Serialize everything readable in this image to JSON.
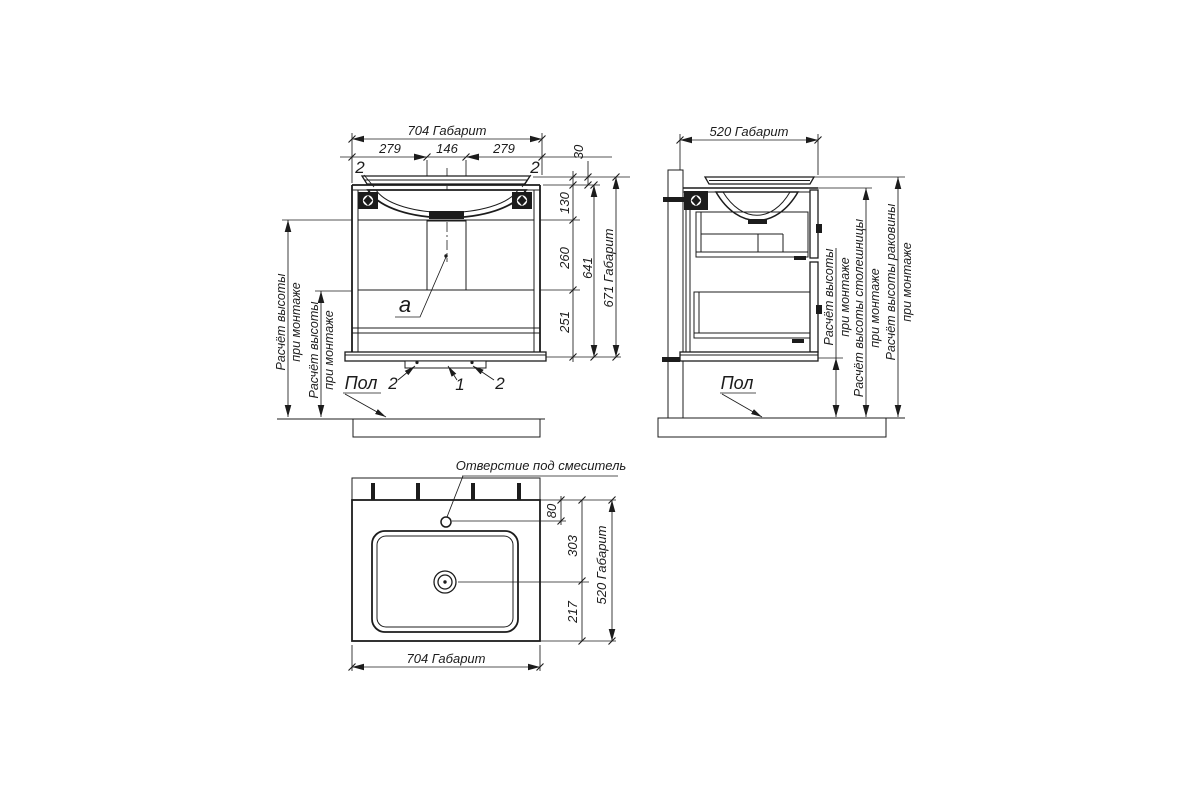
{
  "meta": {
    "background": "#ffffff",
    "line_color": "#1c1c1c"
  },
  "front_view": {
    "dim_overall_width": "704 Габарит",
    "dim_width_left": "279",
    "dim_width_center": "146",
    "dim_width_right": "279",
    "dim_rim_height": "30",
    "dim_upper": "130",
    "dim_middle": "260",
    "dim_lower": "251",
    "dim_carcass_height": "641",
    "dim_overall_height": "671 Габарит",
    "callout_top_left": "2",
    "callout_top_right": "2",
    "panel_label": "a",
    "callout_bottom_left": "2",
    "callout_bottom_center": "1",
    "callout_bottom_right": "2",
    "floor_label": "Пол",
    "note1_line1": "Расчёт высоты",
    "note1_line2": "при монтаже",
    "note2_line1": "Расчёт высоты",
    "note2_line2": "при монтаже"
  },
  "side_view": {
    "dim_overall_depth": "520 Габарит",
    "floor_label": "Пол",
    "note_height_line1": "Расчёт высоты",
    "note_height_line2": "при монтаже",
    "note_countertop_line1": "Расчёт высоты столешницы",
    "note_countertop_line2": "при монтаже",
    "note_sink_line1": "Расчёт высоты раковины",
    "note_sink_line2": "при монтаже"
  },
  "plan_view": {
    "mixer_hole_label": "Отверстие под смеситель",
    "dim_hole_offset": "80",
    "dim_back_to_drain": "303",
    "dim_drain_to_front": "217",
    "dim_overall_depth": "520 Габарит",
    "dim_overall_width": "704 Габарит"
  }
}
